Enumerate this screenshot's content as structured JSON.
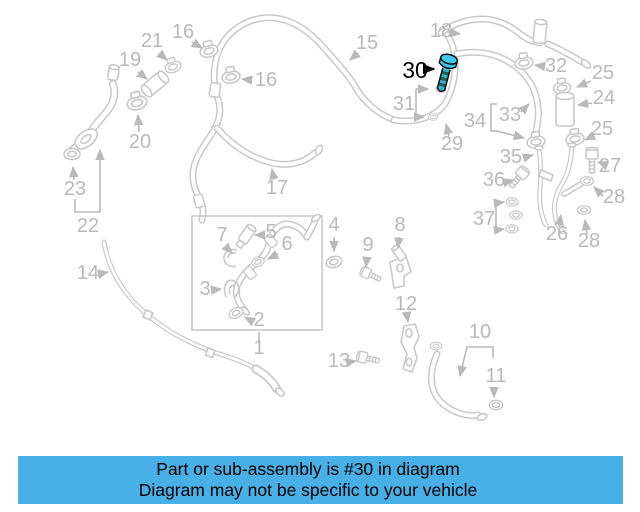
{
  "colors": {
    "background": "#ffffff",
    "diagram_line": "#c9c9c9",
    "label_gray": "#b9b9b9",
    "callout_black": "#000000",
    "highlight": "#3fc8e8",
    "highlight_mid": "#35b4cf",
    "highlight_dark": "#176157",
    "outline": "#000000",
    "caption_bg": "#49b0e7",
    "caption_text": "#000000"
  },
  "highlight": {
    "number": "30"
  },
  "labels": {
    "n1": "1",
    "n2": "2",
    "n3": "3",
    "n4": "4",
    "n5": "5",
    "n6": "6",
    "n7": "7",
    "n8": "8",
    "n9": "9",
    "n10": "10",
    "n11": "11",
    "n12": "12",
    "n13": "13",
    "n14": "14",
    "n15": "15",
    "n16a": "16",
    "n16b": "16",
    "n17": "17",
    "n18": "18",
    "n19": "19",
    "n20": "20",
    "n21": "21",
    "n22": "22",
    "n23": "23",
    "n24": "24",
    "n25a": "25",
    "n25b": "25",
    "n26": "26",
    "n27": "27",
    "n28a": "28",
    "n28b": "28",
    "n29": "29",
    "n31": "31",
    "n32": "32",
    "n33": "33",
    "n34": "34",
    "n35": "35",
    "n36": "36",
    "n37": "37"
  },
  "caption": {
    "line1": "Part or sub-assembly is #30 in diagram",
    "line2": "Diagram may not be specific to your vehicle"
  }
}
